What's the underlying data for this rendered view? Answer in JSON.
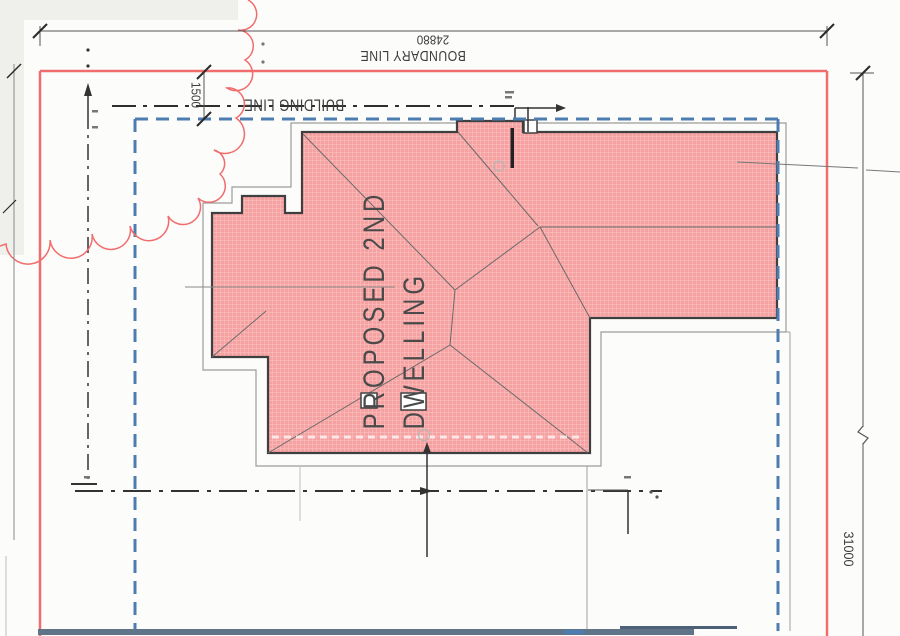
{
  "labels": {
    "boundary_line": "BOUNDARY LINE",
    "building_line": "BUILDING LINE",
    "proposed_dwelling_line1": "PROPOSED 2ND",
    "proposed_dwelling_line2": "DWELLING"
  },
  "dimensions": {
    "site_width": "24880",
    "site_depth": "31000",
    "building_line_setback": "1500"
  },
  "colors": {
    "boundary_red": "#f16c6c",
    "building_line_blue": "#4d7cb0",
    "roof_fill_pink": "#f6a1a1",
    "roof_outline": "#3f3f3f",
    "eaves_gray": "#9b9b9b",
    "centerline_dark": "#2e2e2e",
    "bottom_band": "#5f7486",
    "paper": "#fcfcfb"
  }
}
